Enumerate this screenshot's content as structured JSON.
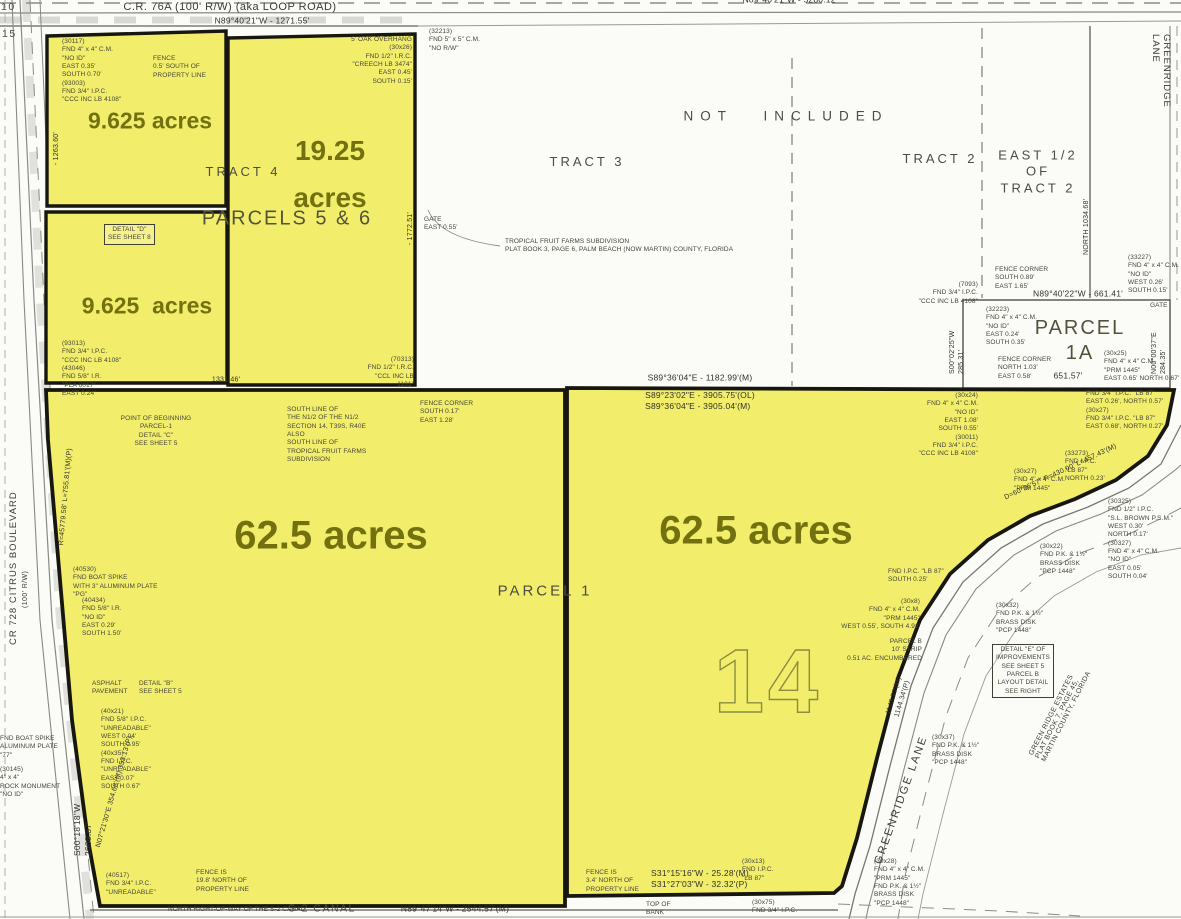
{
  "colors": {
    "parcel_fill": "#f2ee6b",
    "parcel_border": "#17170f",
    "acre_text": "#73710f",
    "map_line": "#8a8a82",
    "note_text": "#45453a",
    "bg": "#fbfbf8"
  },
  "map": {
    "section_number": "14",
    "annotations": [
      {
        "name": "acreage-parcel5-north",
        "t": "9.625 acres",
        "x": 150,
        "y": 121,
        "cls": "acre",
        "ctr": true
      },
      {
        "name": "acreage-parcel6-line1",
        "t": "19.25",
        "x": 330,
        "y": 151,
        "cls": "acre acre-big",
        "ctr": true
      },
      {
        "name": "acreage-parcel6-line2",
        "t": "acres",
        "x": 330,
        "y": 198,
        "cls": "acre acre-big",
        "ctr": true
      },
      {
        "name": "acreage-parcel5-south",
        "t": "9.625  acres",
        "x": 147,
        "y": 306,
        "cls": "acre",
        "ctr": true
      },
      {
        "name": "acreage-parcel1-west",
        "t": "62.5 acres",
        "x": 331,
        "y": 536,
        "cls": "acre acre-xl",
        "ctr": true
      },
      {
        "name": "acreage-parcel1-east",
        "t": "62.5 acres",
        "x": 756,
        "y": 531,
        "cls": "acre acre-xl",
        "ctr": true
      },
      {
        "name": "label-not-included",
        "t": "NOT  INCLUDED",
        "x": 786,
        "y": 117,
        "cls": "region region-sp",
        "ctr": true
      },
      {
        "name": "label-tract-3",
        "t": "TRACT 3",
        "x": 587,
        "y": 162,
        "cls": "region",
        "ctr": true
      },
      {
        "name": "label-tract-2",
        "t": "TRACT 2",
        "x": 940,
        "y": 159,
        "cls": "region",
        "ctr": true
      },
      {
        "name": "label-east-half-tract-2",
        "t": "EAST 1/2\nOF\nTRACT 2",
        "x": 1038,
        "y": 172,
        "cls": "region",
        "ctr": true
      },
      {
        "name": "label-tract-4",
        "t": "TRACT 4",
        "x": 243,
        "y": 172,
        "cls": "region",
        "ctr": true
      },
      {
        "name": "label-parcels-5-6",
        "t": "PARCELS 5 & 6",
        "x": 287,
        "y": 219,
        "cls": "region region-lg",
        "ctr": true
      },
      {
        "name": "label-parcel-1a",
        "t": "PARCEL 1A",
        "x": 1080,
        "y": 341,
        "cls": "region region-lg",
        "ctr": true
      },
      {
        "name": "label-parcel-1",
        "t": "PARCEL 1",
        "x": 545,
        "y": 592,
        "cls": "region region-md",
        "ctr": true
      },
      {
        "name": "label-s2-canal",
        "t": "S-2 CANAL",
        "x": 322,
        "y": 909,
        "cls": "region region-sm",
        "ctr": true
      },
      {
        "name": "label-section-10",
        "t": "10",
        "x": 1,
        "y": 1,
        "cls": "region region-sm"
      },
      {
        "name": "label-section-15",
        "t": "15",
        "x": 2,
        "y": 28,
        "cls": "region region-sm"
      },
      {
        "name": "label-cr-76a",
        "t": "C.R. 76A (100' R/W) (aka LOOP ROAD)",
        "x": 230,
        "y": 7,
        "cls": "road",
        "ctr": true
      },
      {
        "name": "label-cr-728",
        "t": "CR 728 CITRUS BOULEVARD",
        "x": 8,
        "y": 645,
        "r": -90,
        "cls": "road road-sm"
      },
      {
        "name": "label-cr-728-rw",
        "t": "(100' R/W)",
        "x": 22,
        "y": 608,
        "r": -90,
        "cls": "road road-xs"
      },
      {
        "name": "label-greenridge-lane-north",
        "t": "GREENRIDGE LANE",
        "x": 1172,
        "y": 34,
        "r": 90,
        "cls": "road road-sm"
      },
      {
        "name": "label-greenridge-lane-south",
        "t": "GREENRIDGE LANE",
        "x": 901,
        "y": 800,
        "r": -70,
        "cls": "road road-md",
        "ctr": true
      },
      {
        "name": "label-green-ridge-estates",
        "t": "GREEN RIDGE ESTATES\nPLAT BOOK 7, PAGE 45, MARTIN COUNTY, FLORIDA",
        "x": 1064,
        "y": 706,
        "r": -63,
        "cls": "road road-xs",
        "ctr": true
      },
      {
        "name": "dim-north-boundary",
        "t": "N89°40'21\"W  -  1271.55'",
        "x": 262,
        "y": 21,
        "cls": "dim",
        "ctr": true
      },
      {
        "name": "dim-section-line",
        "t": "N89°40'21\"W  -  5280.12'",
        "x": 790,
        "y": 0,
        "cls": "dim",
        "ctr": true
      },
      {
        "name": "dim-1182",
        "t": "S89°36'04\"E  -  1182.99'(M)",
        "x": 700,
        "y": 378,
        "cls": "dim",
        "ctr": true
      },
      {
        "name": "dim-3905",
        "t": "S89°23'02\"E  -  3905.75'(OL)\nS89°36'04\"E  -  3905.04'(M)",
        "x": 700,
        "y": 401,
        "cls": "dim",
        "ctr": true
      },
      {
        "name": "dim-661",
        "t": "N89°40'22\"W  -  661.41'",
        "x": 1078,
        "y": 294,
        "cls": "dim",
        "ctr": true
      },
      {
        "name": "dim-651",
        "t": "651.57'",
        "x": 1068,
        "y": 376,
        "cls": "dim",
        "ctr": true
      },
      {
        "name": "dim-2544",
        "t": "N89°47'14\"W  -  2544.57'(M)",
        "x": 455,
        "y": 909,
        "cls": "dim",
        "ctr": true
      },
      {
        "name": "dim-s31",
        "t": "S31°15'16\"W  -  25.28'(M)\nS31°27'03\"W  -  32.32'(P)",
        "x": 700,
        "y": 879,
        "cls": "dim",
        "ctr": true
      },
      {
        "name": "dim-west-2668",
        "t": "S00°18'18\"W\n2668.87'",
        "x": 72,
        "y": 856,
        "r": -90,
        "cls": "dim"
      },
      {
        "name": "dim-1a-west",
        "t": "S00°02'25\"W\n285.31'",
        "x": 948,
        "y": 374,
        "r": -90,
        "cls": "dim dim-xs"
      },
      {
        "name": "dim-1a-east",
        "t": "N00°00'37\"E\n284.35'",
        "x": 1150,
        "y": 374,
        "r": -90,
        "cls": "dim dim-xs"
      },
      {
        "name": "dim-north-1034",
        "t": "NORTH 1034.68'",
        "x": 1082,
        "y": 255,
        "r": -90,
        "cls": "dim dim-xs"
      },
      {
        "name": "dim-1263",
        "t": "-  1263.60'",
        "x": 52,
        "y": 165,
        "r": -90,
        "cls": "dim dim-xs"
      },
      {
        "name": "dim-1772",
        "t": "-  1772.51'",
        "x": 406,
        "y": 245,
        "r": -90,
        "cls": "dim dim-xs"
      },
      {
        "name": "dim-1331",
        "t": "1331.46'",
        "x": 226,
        "y": 380,
        "cls": "dim dim-xs",
        "ctr": true
      },
      {
        "name": "dim-1145",
        "t": "1145.77'(M)\n1144.34'(P)",
        "x": 884,
        "y": 713,
        "r": -73,
        "cls": "dim dim-xs"
      },
      {
        "name": "dim-curve-east",
        "t": "D=60°26'57\"  R=430.00'  L=457.43'(M)",
        "x": 1003,
        "y": 494,
        "r": -25,
        "cls": "dim dim-xs"
      },
      {
        "name": "dim-curve-west",
        "t": "R=45779.58'  L=755.81'(M)(P)",
        "x": 57,
        "y": 545,
        "r": -85,
        "cls": "dim dim-xs"
      },
      {
        "name": "dim-354",
        "t": "N07°21'30\"E  354.68'(M)  353.13'(P)",
        "x": 94,
        "y": 846,
        "r": -74,
        "cls": "dim dim-xs"
      },
      {
        "name": "note-monument-nw",
        "t": "(30117)\nFND 4\" x 4\" C.M.\n\"NO ID\"\nEAST 0.35'\nSOUTH 0.70'\n(93003)\nFND 3/4\" I.P.C.\n\"CCC INC LB 4108\"",
        "x": 62,
        "y": 38,
        "cls": "note"
      },
      {
        "name": "note-fence-north",
        "t": "FENCE\n0.5' SOUTH OF\nPROPERTY LINE",
        "x": 153,
        "y": 55,
        "cls": "note"
      },
      {
        "name": "note-oak-overhang",
        "t": "5' OAK OVERHANG\n(30x26)\nFND 1/2\" I.R.C.\n\"CREECH LB 3474\"\nEAST 0.45'\nSOUTH 0.15'",
        "x": 330,
        "y": 36,
        "w": 82,
        "ta": "right",
        "cls": "note"
      },
      {
        "name": "note-32213",
        "t": "(32213)\nFND 5\" x 5\" C.M.\n\"NO R/W\"",
        "x": 429,
        "y": 28,
        "cls": "note"
      },
      {
        "name": "note-gate-east",
        "t": "GATE\nEAST 0.55'",
        "x": 424,
        "y": 216,
        "cls": "note"
      },
      {
        "name": "note-detail-d",
        "t": "DETAIL \"D\"\nSEE SHEET 8",
        "x": 104,
        "y": 224,
        "ta": "center",
        "cls": "note note-box"
      },
      {
        "name": "note-tropical-fruit",
        "t": "TROPICAL FRUIT FARMS SUBDIVISION\nPLAT BOOK 3, PAGE 6, PALM BEACH (NOW MARTIN) COUNTY, FLORIDA",
        "x": 505,
        "y": 238,
        "cls": "note"
      },
      {
        "name": "note-93013",
        "t": "(93013)\nFND 3/4\" I.P.C.\n\"CCC INC LB 4108\"\n(43046)\nFND 5/8\" I.R.\n\"PLA 6017\"\nEAST 0.24'",
        "x": 62,
        "y": 340,
        "cls": "note"
      },
      {
        "name": "note-70313",
        "t": "(70313)\nFND 1/2\" I.R.C.\n\"CCL INC LB 1101\"",
        "x": 358,
        "y": 356,
        "w": 56,
        "ta": "right",
        "cls": "note"
      },
      {
        "name": "note-fence-corner-mid",
        "t": "FENCE CORNER\nSOUTH 0.17'\nEAST 1.28'",
        "x": 420,
        "y": 400,
        "cls": "note"
      },
      {
        "name": "note-7093",
        "t": "(7093)\nFND 3/4\" I.P.C.\n\"CCC INC LB 4108\"",
        "x": 908,
        "y": 281,
        "w": 70,
        "ta": "right",
        "cls": "note"
      },
      {
        "name": "note-fence-corner-1a-nw",
        "t": "FENCE CORNER\nSOUTH 0.89'\nEAST 1.65'",
        "x": 995,
        "y": 266,
        "cls": "note"
      },
      {
        "name": "note-32223",
        "t": "(32223)\nFND 4\" x 4\" C.M.\n\"NO ID\"\nEAST 0.24'\nSOUTH 0.35'",
        "x": 986,
        "y": 306,
        "cls": "note"
      },
      {
        "name": "note-fence-corner-1a-sw",
        "t": "FENCE CORNER\nNORTH 1.03'\nEAST 0.58'",
        "x": 998,
        "y": 356,
        "cls": "note"
      },
      {
        "name": "note-33227",
        "t": "(33227)\nFND 4\" x 4\" C.M.\n\"NO ID\"\nWEST 0.26'\nSOUTH 0.15'",
        "x": 1128,
        "y": 254,
        "cls": "note"
      },
      {
        "name": "note-gate-1a",
        "t": "GATE",
        "x": 1150,
        "y": 302,
        "cls": "note"
      },
      {
        "name": "note-30x25",
        "t": "(30x25)\nFND 4\" x 4\" C.M.\n\"PRM 1445\"\nEAST 0.65'  NORTH 0.67'",
        "x": 1104,
        "y": 350,
        "cls": "note"
      },
      {
        "name": "note-point-of-beginning",
        "t": "POINT OF BEGINNING\nPARCEL-1\nDETAIL \"C\"\nSEE SHEET 5",
        "x": 110,
        "y": 415,
        "w": 92,
        "ta": "center",
        "cls": "note"
      },
      {
        "name": "note-south-line",
        "t": "SOUTH LINE OF\nTHE N1/2 OF THE N1/2\nSECTION 14, T39S, R40E\nALSO\nSOUTH LINE OF\nTROPICAL FRUIT FARMS\nSUBDIVISION",
        "x": 287,
        "y": 406,
        "cls": "note"
      },
      {
        "name": "note-lb87-ne",
        "t": "FND 3/4\" I.P.C. \"LB 87\"\nEAST 0.26', NORTH 0.57'\n(30x27)\nFND 3/4\" I.P.C. \"LB 87\"\nEAST 0.68', NORTH 0.27'",
        "x": 1086,
        "y": 390,
        "cls": "note"
      },
      {
        "name": "note-30x24",
        "t": "(30x24)\nFND 4\" x 4\" C.M.\n\"NO ID\"\nEAST 1.08'\nSOUTH 0.55'\n(30011)\nFND 3/4\" I.P.C.\n\"CCC INC LB 4108\"",
        "x": 902,
        "y": 392,
        "w": 76,
        "ta": "right",
        "cls": "note"
      },
      {
        "name": "note-33273",
        "t": "(33273)\nFND I.P.C.\n\"LB 87\"\nNORTH 0.23'",
        "x": 1065,
        "y": 450,
        "cls": "note"
      },
      {
        "name": "note-30x27-prm",
        "t": "(30x27)\nFND 4\" x 4\" C.M.\n\"PRM 1445\"",
        "x": 1014,
        "y": 468,
        "cls": "note"
      },
      {
        "name": "note-30325",
        "t": "(30325)\nFND 1/2\" I.P.C.\n\"S.L. BROWN P.S.M.\"\nWEST 0.30'\nNORTH 0.17'\n(30327)\nFND 4\" x 4\" C.M.\n\"NO ID\"\nEAST 0.05'\nSOUTH 0.04'",
        "x": 1108,
        "y": 498,
        "cls": "note"
      },
      {
        "name": "note-30x22",
        "t": "(30x22)\nFND P.K. & 1½\"\nBRASS DISK\n\"PCP 1448\"",
        "x": 1040,
        "y": 543,
        "cls": "note"
      },
      {
        "name": "note-lb87-south",
        "t": "FND I.P.C. \"LB 87\"\nSOUTH 0.25'",
        "x": 888,
        "y": 568,
        "cls": "note"
      },
      {
        "name": "note-30x8",
        "t": "(30x8)\nFND 4\" x 4\" C.M.\n\"PRM 1445\"\nWEST 0.55', SOUTH 4.92'",
        "x": 840,
        "y": 598,
        "w": 80,
        "ta": "right",
        "cls": "note"
      },
      {
        "name": "note-parcel-b-strip",
        "t": "PARCEL B\n10' STRIP\n0.51 AC. ENCUMBERED",
        "x": 846,
        "y": 638,
        "w": 76,
        "ta": "right",
        "cls": "note"
      },
      {
        "name": "note-30x32",
        "t": "(30x32)\nFND P.K. & 1½\"\nBRASS DISK\n\"PCP 1448\"",
        "x": 996,
        "y": 602,
        "cls": "note"
      },
      {
        "name": "note-detail-e",
        "t": "DETAIL \"E\" OF\nIMPROVEMENTS\nSEE SHEET 5\nPARCEL B\nLAYOUT DETAIL\nSEE RIGHT",
        "x": 992,
        "y": 644,
        "ta": "center",
        "cls": "note note-box"
      },
      {
        "name": "note-30x37",
        "t": "(30x37)\nFND P.K. & 1½\"\nBRASS DISK\n\"PCP 1448\"",
        "x": 932,
        "y": 734,
        "cls": "note"
      },
      {
        "name": "note-40530",
        "t": "(40530)\nFND BOAT SPIKE\nWITH 3\" ALUMINUM PLATE\n\"PG\"",
        "x": 73,
        "y": 566,
        "cls": "note"
      },
      {
        "name": "note-40434",
        "t": "(40434)\nFND 5/8\" I.R.\n\"NO ID\"\nEAST 0.29'\nSOUTH 1.50'",
        "x": 82,
        "y": 597,
        "cls": "note"
      },
      {
        "name": "note-asphalt",
        "t": "ASPHALT\nPAVEMENT",
        "x": 92,
        "y": 680,
        "cls": "note"
      },
      {
        "name": "note-detail-b",
        "t": "DETAIL \"B\"\nSEE SHEET 5",
        "x": 139,
        "y": 680,
        "cls": "note"
      },
      {
        "name": "note-unreadable",
        "t": "(40x21)\nFND 5/8\" I.P.C.\n\"UNREADABLE\"\nWEST 0.04'\nSOUTH 0.95'\n(40x35)\nFND I.P.C.\n\"UNREADABLE\"\nEAST 0.07'\nSOUTH 0.67'",
        "x": 101,
        "y": 708,
        "cls": "note"
      },
      {
        "name": "note-boat-spike-west",
        "t": "FND BOAT SPIKE\nALUMINUM PLATE\n\"77\"",
        "x": 0,
        "y": 735,
        "cls": "note"
      },
      {
        "name": "note-rock-monument",
        "t": "(30145)\n4\" x 4\"\nROCK MONUMENT\n\"NO ID\"",
        "x": 0,
        "y": 766,
        "cls": "note"
      },
      {
        "name": "note-40517",
        "t": "(40517)\nFND 3/4\" I.P.C.\n\"UNREADABLE\"",
        "x": 106,
        "y": 872,
        "cls": "note"
      },
      {
        "name": "note-fence-198",
        "t": "FENCE IS\n19.8' NORTH OF\nPROPERTY LINE",
        "x": 196,
        "y": 869,
        "cls": "note"
      },
      {
        "name": "note-canal-row",
        "t": "NORTH RIGHT-OF-WAY OF THE S-2 CANAL",
        "x": 168,
        "y": 906,
        "cls": "note"
      },
      {
        "name": "note-fence-34",
        "t": "FENCE IS\n3.4' NORTH OF\nPROPERTY LINE",
        "x": 586,
        "y": 869,
        "cls": "note"
      },
      {
        "name": "note-top-of-bank",
        "t": "TOP OF\nBANK",
        "x": 646,
        "y": 901,
        "cls": "note"
      },
      {
        "name": "note-30x13",
        "t": "(30x13)\nFND I.P.C.\n\"LB 87\"",
        "x": 742,
        "y": 858,
        "cls": "note"
      },
      {
        "name": "note-30x75",
        "t": "(30x75)\nFND 3/4\" I.P.C.",
        "x": 752,
        "y": 899,
        "cls": "note"
      },
      {
        "name": "note-30x28-corner",
        "t": "(30x28)\nFND 4\" x 4\" C.M.\n\"PRM 1445\"\nFND P.K. & 1½\"\nBRASS DISK\n\"PCP 1448\"",
        "x": 874,
        "y": 858,
        "cls": "note"
      }
    ]
  }
}
